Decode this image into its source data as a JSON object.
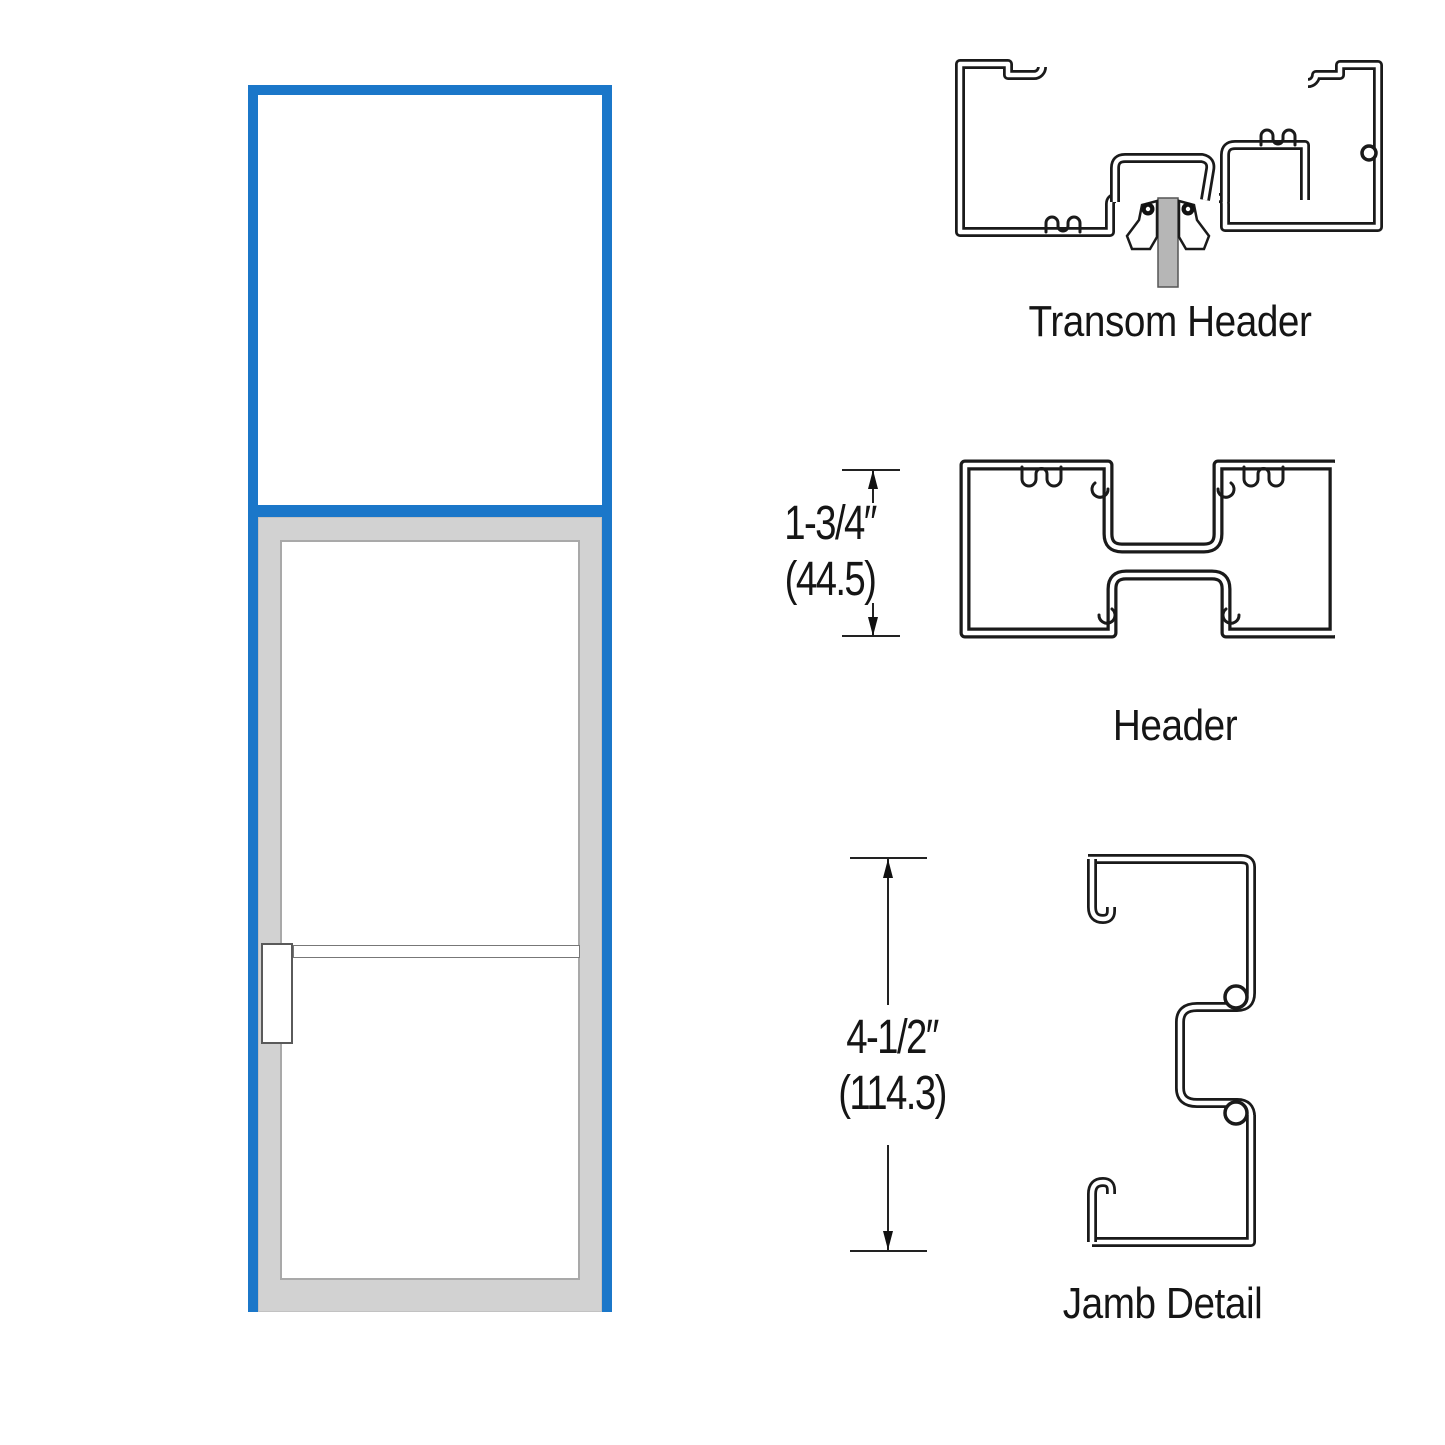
{
  "title": "Door with transom elevation and frame section details",
  "colors": {
    "frame_blue": "#1b77c9",
    "door_gray": "#d2d2d2",
    "glass_white": "#ffffff",
    "line_black": "#1a1a1a"
  },
  "elevation": {
    "parts": [
      "transom-panel",
      "door-leaf",
      "door-glass",
      "push-bar"
    ]
  },
  "details": {
    "transom_header": {
      "label": "Transom Header"
    },
    "header": {
      "label": "Header",
      "dim_in": "1-3/4″",
      "dim_mm": "(44.5)"
    },
    "jamb": {
      "label": "Jamb Detail",
      "dim_in": "4-1/2″",
      "dim_mm": "(114.3)"
    }
  }
}
